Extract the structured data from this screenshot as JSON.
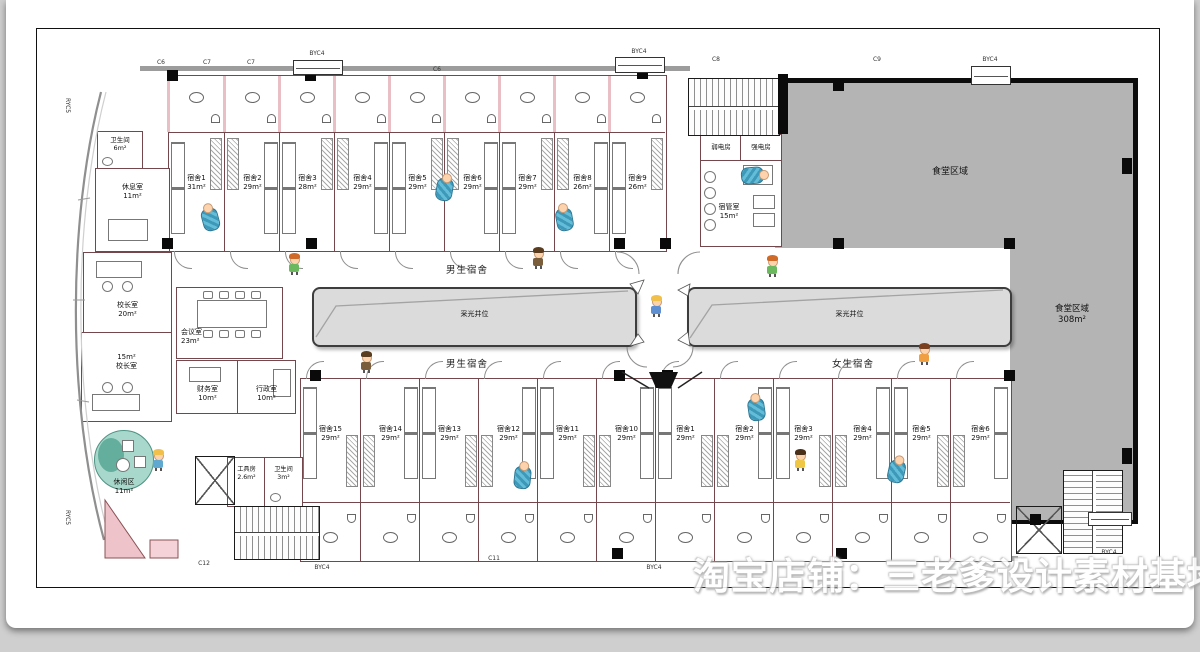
{
  "watermark": "淘宝店铺：三老爹设计素材基地",
  "plan": {
    "corridor_boys_top": "男生宿舍",
    "corridor_boys_bottom": "男生宿舍",
    "corridor_girls": "女生宿舍",
    "light_well": "采光井位",
    "canteen": {
      "zone_label": "食堂区域",
      "zone2_label": "食堂区域",
      "zone2_area": "308m²"
    },
    "service": {
      "weak_power": "弱电房",
      "strong_power": "强电房",
      "dorm_admin_name": "宿管室",
      "dorm_admin_area": "15m²"
    },
    "left_rooms": {
      "toilet_top_name": "卫生间",
      "toilet_top_area": "6m²",
      "rest_name": "休息室",
      "rest_area": "11m²",
      "principal1_name": "校长室",
      "principal1_area": "20m²",
      "principal2_area": "15m²",
      "principal2_name": "校长室",
      "meeting_name": "会议室",
      "meeting_area": "23m²",
      "finance_name": "财务室",
      "finance_area": "10m²",
      "admin_name": "行政室",
      "admin_area": "10m²",
      "leisure_name": "休闲区",
      "leisure_area": "11m²",
      "tools_name": "工具房",
      "tools_area": "2.6m²",
      "toilet_bottom_name": "卫生间",
      "toilet_bottom_area": "3m²"
    },
    "rooms_top": [
      {
        "name": "宿舍1",
        "area": "31m²"
      },
      {
        "name": "宿舍2",
        "area": "29m²"
      },
      {
        "name": "宿舍3",
        "area": "28m²"
      },
      {
        "name": "宿舍4",
        "area": "29m²"
      },
      {
        "name": "宿舍5",
        "area": "29m²"
      },
      {
        "name": "宿舍6",
        "area": "29m²"
      },
      {
        "name": "宿舍7",
        "area": "29m²"
      },
      {
        "name": "宿舍8",
        "area": "26m²"
      },
      {
        "name": "宿舍9",
        "area": "26m²"
      }
    ],
    "rooms_bottom": [
      {
        "name": "宿舍15",
        "area": "29m²"
      },
      {
        "name": "宿舍14",
        "area": "29m²"
      },
      {
        "name": "宿舍13",
        "area": "29m²"
      },
      {
        "name": "宿舍12",
        "area": "29m²"
      },
      {
        "name": "宿舍11",
        "area": "29m²"
      },
      {
        "name": "宿舍10",
        "area": "29m²"
      },
      {
        "name": "宿舍1",
        "area": "29m²"
      },
      {
        "name": "宿舍2",
        "area": "29m²"
      },
      {
        "name": "宿舍3",
        "area": "29m²"
      },
      {
        "name": "宿舍4",
        "area": "29m²"
      },
      {
        "name": "宿舍5",
        "area": "29m²"
      },
      {
        "name": "宿舍6",
        "area": "29m²"
      }
    ],
    "tags": [
      {
        "text": "RYC5",
        "x": 64,
        "y": 98,
        "v": 1
      },
      {
        "text": "RYC5",
        "x": 64,
        "y": 510,
        "v": 1
      },
      {
        "text": "C6",
        "x": 161,
        "y": 59
      },
      {
        "text": "C7",
        "x": 207,
        "y": 59
      },
      {
        "text": "C7",
        "x": 251,
        "y": 59
      },
      {
        "text": "BYC4",
        "x": 317,
        "y": 50
      },
      {
        "text": "C6",
        "x": 437,
        "y": 66
      },
      {
        "text": "BYC4",
        "x": 639,
        "y": 48
      },
      {
        "text": "C8",
        "x": 716,
        "y": 56
      },
      {
        "text": "C9",
        "x": 877,
        "y": 56
      },
      {
        "text": "BYC4",
        "x": 990,
        "y": 56
      },
      {
        "text": "C12",
        "x": 204,
        "y": 560
      },
      {
        "text": "BYC4",
        "x": 322,
        "y": 564
      },
      {
        "text": "C11",
        "x": 494,
        "y": 555
      },
      {
        "text": "BYC4",
        "x": 654,
        "y": 564
      },
      {
        "text": "BYC4",
        "x": 1109,
        "y": 549
      }
    ]
  }
}
